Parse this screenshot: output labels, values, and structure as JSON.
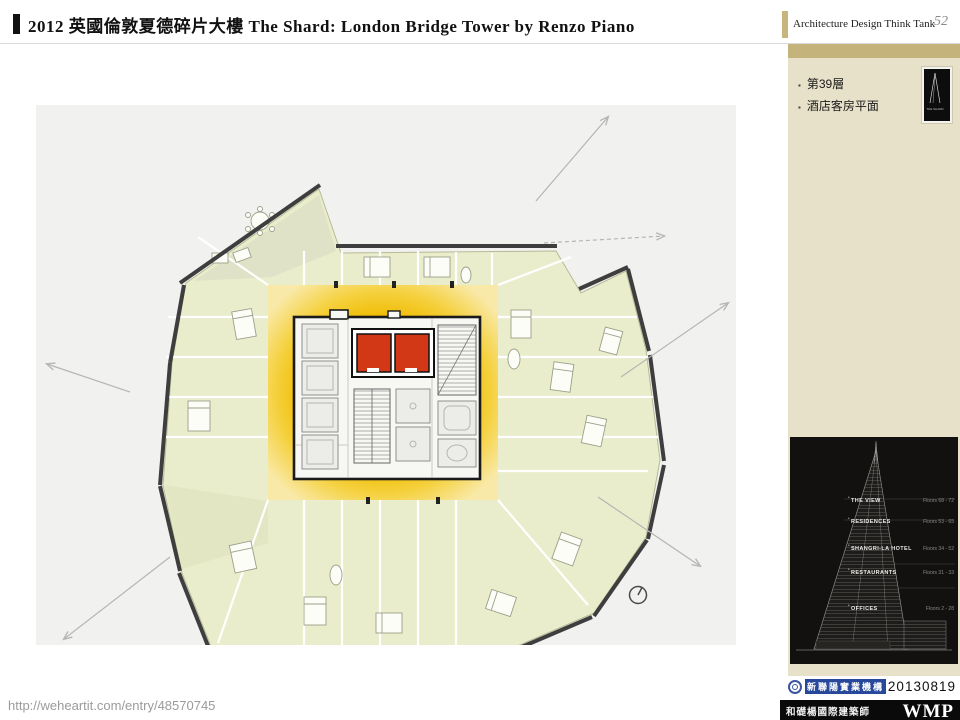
{
  "header": {
    "title": "2012 英國倫敦夏德碎片大樓 The Shard: London Bridge Tower by  Renzo Piano",
    "brand": "Architecture Design Think Tank",
    "page_number": "52"
  },
  "sidebar": {
    "bullet_marker": "▪",
    "bullets": [
      "第39層",
      "酒店客房平面"
    ],
    "shard_logo_text": "THE SHARD",
    "tower_diagram": {
      "sections": [
        {
          "marker": "*",
          "label": "THE VIEW",
          "floors": "Floors 68 - 72"
        },
        {
          "marker": "*",
          "label": "RESIDENCES",
          "floors": "Floors 53 - 65"
        },
        {
          "marker": "*",
          "label": "SHANGRI-LA HOTEL",
          "floors": "Floors 34 - 52"
        },
        {
          "marker": "*",
          "label": "RESTAURANTS",
          "floors": "Floors 31 - 33"
        },
        {
          "marker": "*",
          "label": "OFFICES",
          "floors": "Floors 2 - 28"
        }
      ]
    }
  },
  "plan": {
    "description": "Level 39 hotel guest-room floor plan with central lift core highlighted in red"
  },
  "footer": {
    "source_url": "http://weheartit.com/entry/48570745",
    "date": "20130819",
    "developer_name": "新聯陽實業機構",
    "architect_name": "和礎楊國際建築師",
    "architect_mark": "WMP"
  },
  "colors": {
    "accent_tan": "#C4B47C",
    "sidebar_beige": "#E8E1C9",
    "plan_panel_bg": "#F1F1EF",
    "room_green": "#EAEDCB",
    "core_yellow": "#F0BB00",
    "elevator_red": "#D23716",
    "diagram_bg": "#121110"
  }
}
